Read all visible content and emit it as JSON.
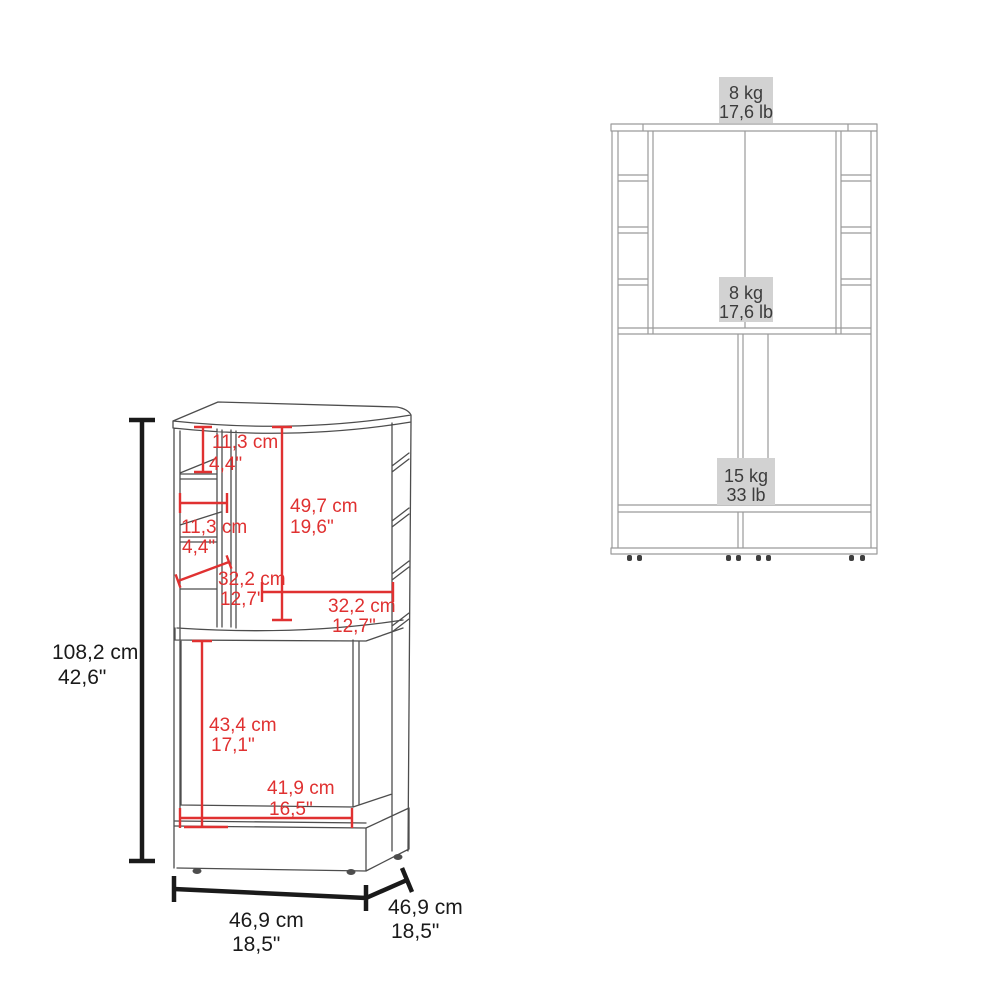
{
  "perspective_view": {
    "dimensions": {
      "overall_height": {
        "cm": "108,2 cm",
        "inches": "42,6\""
      },
      "top_shelf_height": {
        "cm": "11,3 cm",
        "inches": "4,4\""
      },
      "side_shelf_width": {
        "cm": "11,3 cm",
        "inches": "4,4\""
      },
      "door_height": {
        "cm": "49,7 cm",
        "inches": "19,6\""
      },
      "side_shelf_depth": {
        "cm": "32,2 cm",
        "inches": "12,7\""
      },
      "door_width": {
        "cm": "32,2 cm",
        "inches": "12,7\""
      },
      "lower_compartment_height": {
        "cm": "43,4 cm",
        "inches": "17,1\""
      },
      "lower_compartment_width": {
        "cm": "41,9 cm",
        "inches": "16,5\""
      },
      "overall_width": {
        "cm": "46,9 cm",
        "inches": "18,5\""
      },
      "overall_depth": {
        "cm": "46,9 cm",
        "inches": "18,5\""
      }
    }
  },
  "front_view": {
    "load_capacities": {
      "top_surface": {
        "kg": "8 kg",
        "lb": "17,6 lb"
      },
      "middle_shelf": {
        "kg": "8 kg",
        "lb": "17,6 lb"
      },
      "lower_cabinet": {
        "kg": "15 kg",
        "lb": "33 lb"
      }
    }
  },
  "colors": {
    "dimension_red": "#e03131",
    "dimension_black": "#1a1a1a",
    "perspective_line_gray": "#4d4d4d",
    "front_line_gray": "#9a9a9a",
    "capacity_label_bg": "#d2d2d2",
    "capacity_label_text": "#3c3c3c"
  }
}
